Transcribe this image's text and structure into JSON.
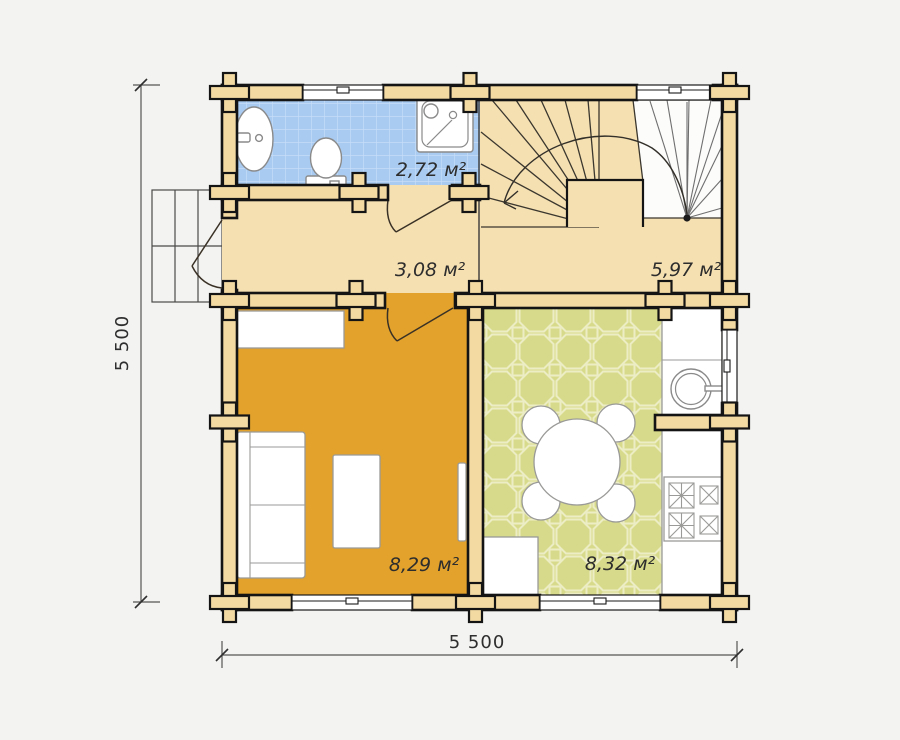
{
  "plan": {
    "type": "floor-plan",
    "floor_dimensions": {
      "width_label": "5 500",
      "height_label": "5 500"
    },
    "rooms": [
      {
        "id": "bathroom",
        "area_label": "2,72 м²"
      },
      {
        "id": "hallway",
        "area_label": "3,08 м²"
      },
      {
        "id": "stair-hall",
        "area_label": "5,97 м²"
      },
      {
        "id": "living-room",
        "area_label": "8,29 м²"
      },
      {
        "id": "kitchen",
        "area_label": "8,32 м²"
      }
    ],
    "colors": {
      "page_bg": "#f3f3f1",
      "wall_fill": "#f3daa2",
      "hall_floor": "#f5e0b2",
      "bathroom_floor": "#a9cbf1",
      "bathroom_grid": "#c9dff9",
      "living_floor": "#e2a22c",
      "kitchen_floor": "#d6da8a",
      "kitchen_pattern": "#ededc5",
      "stair_upper": "#fcfcfb",
      "label_color": "#2d2d2d"
    }
  }
}
